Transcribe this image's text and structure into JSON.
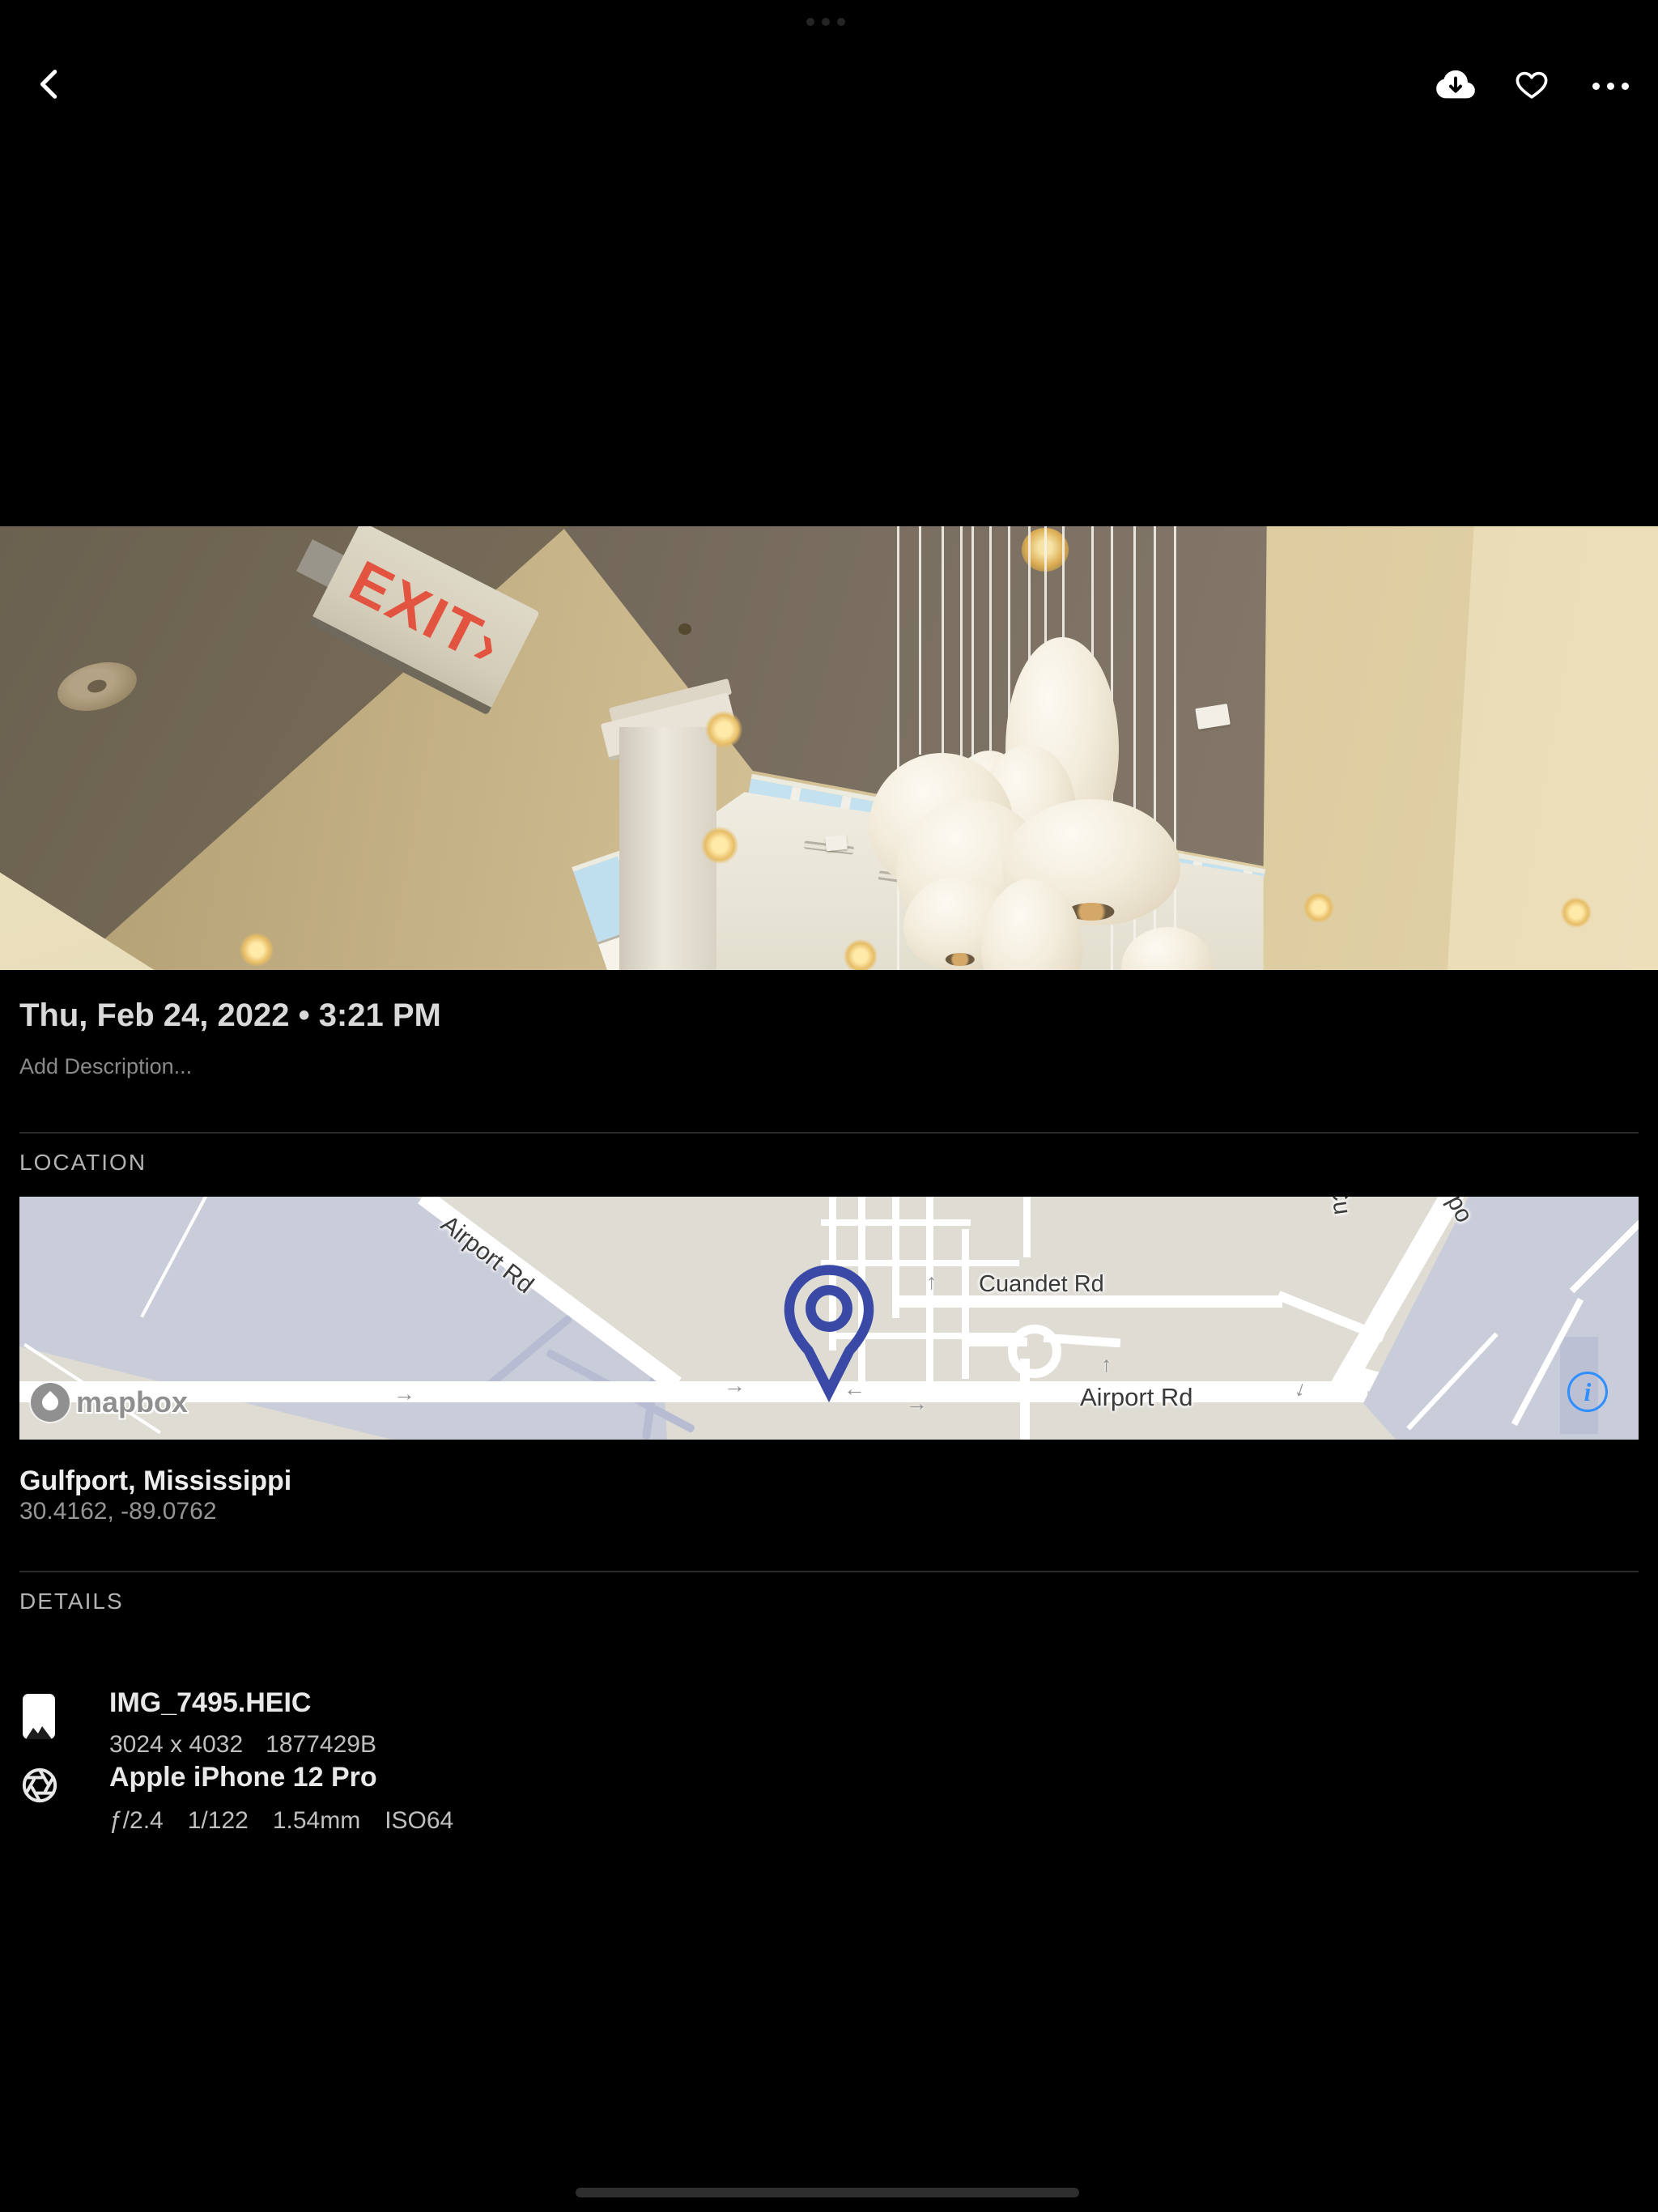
{
  "toolbar": {
    "back_icon": "chevron-left",
    "download_icon": "cloud-download",
    "favorite_icon": "heart-outline",
    "more_icon": "ellipsis"
  },
  "photo": {
    "exit_sign_text": "EXIT›"
  },
  "meta": {
    "date": "Thu, Feb 24, 2022 • 3:21 PM",
    "description_placeholder": "Add Description..."
  },
  "location": {
    "header": "LOCATION",
    "place": "Gulfport, Mississippi",
    "coordinates": "30.4162, -89.0762",
    "map": {
      "attribution": "mapbox",
      "info_label": "i",
      "roads": {
        "airport_rd_diagonal": "Airport Rd",
        "cuandet_rd": "Cuandet Rd",
        "airport_rd_main": "Airport Rd",
        "airport_rd_clipped": "Airpo",
        "clipped_street": "Cu"
      }
    }
  },
  "details": {
    "header": "DETAILS",
    "file": {
      "name": "IMG_7495.HEIC",
      "dimensions": "3024 x 4032",
      "size": "1877429B"
    },
    "camera": {
      "name": "Apple iPhone 12 Pro",
      "aperture": "ƒ/2.4",
      "shutter_speed": "1/122",
      "focal_length": "1.54mm",
      "iso": "ISO64"
    }
  }
}
